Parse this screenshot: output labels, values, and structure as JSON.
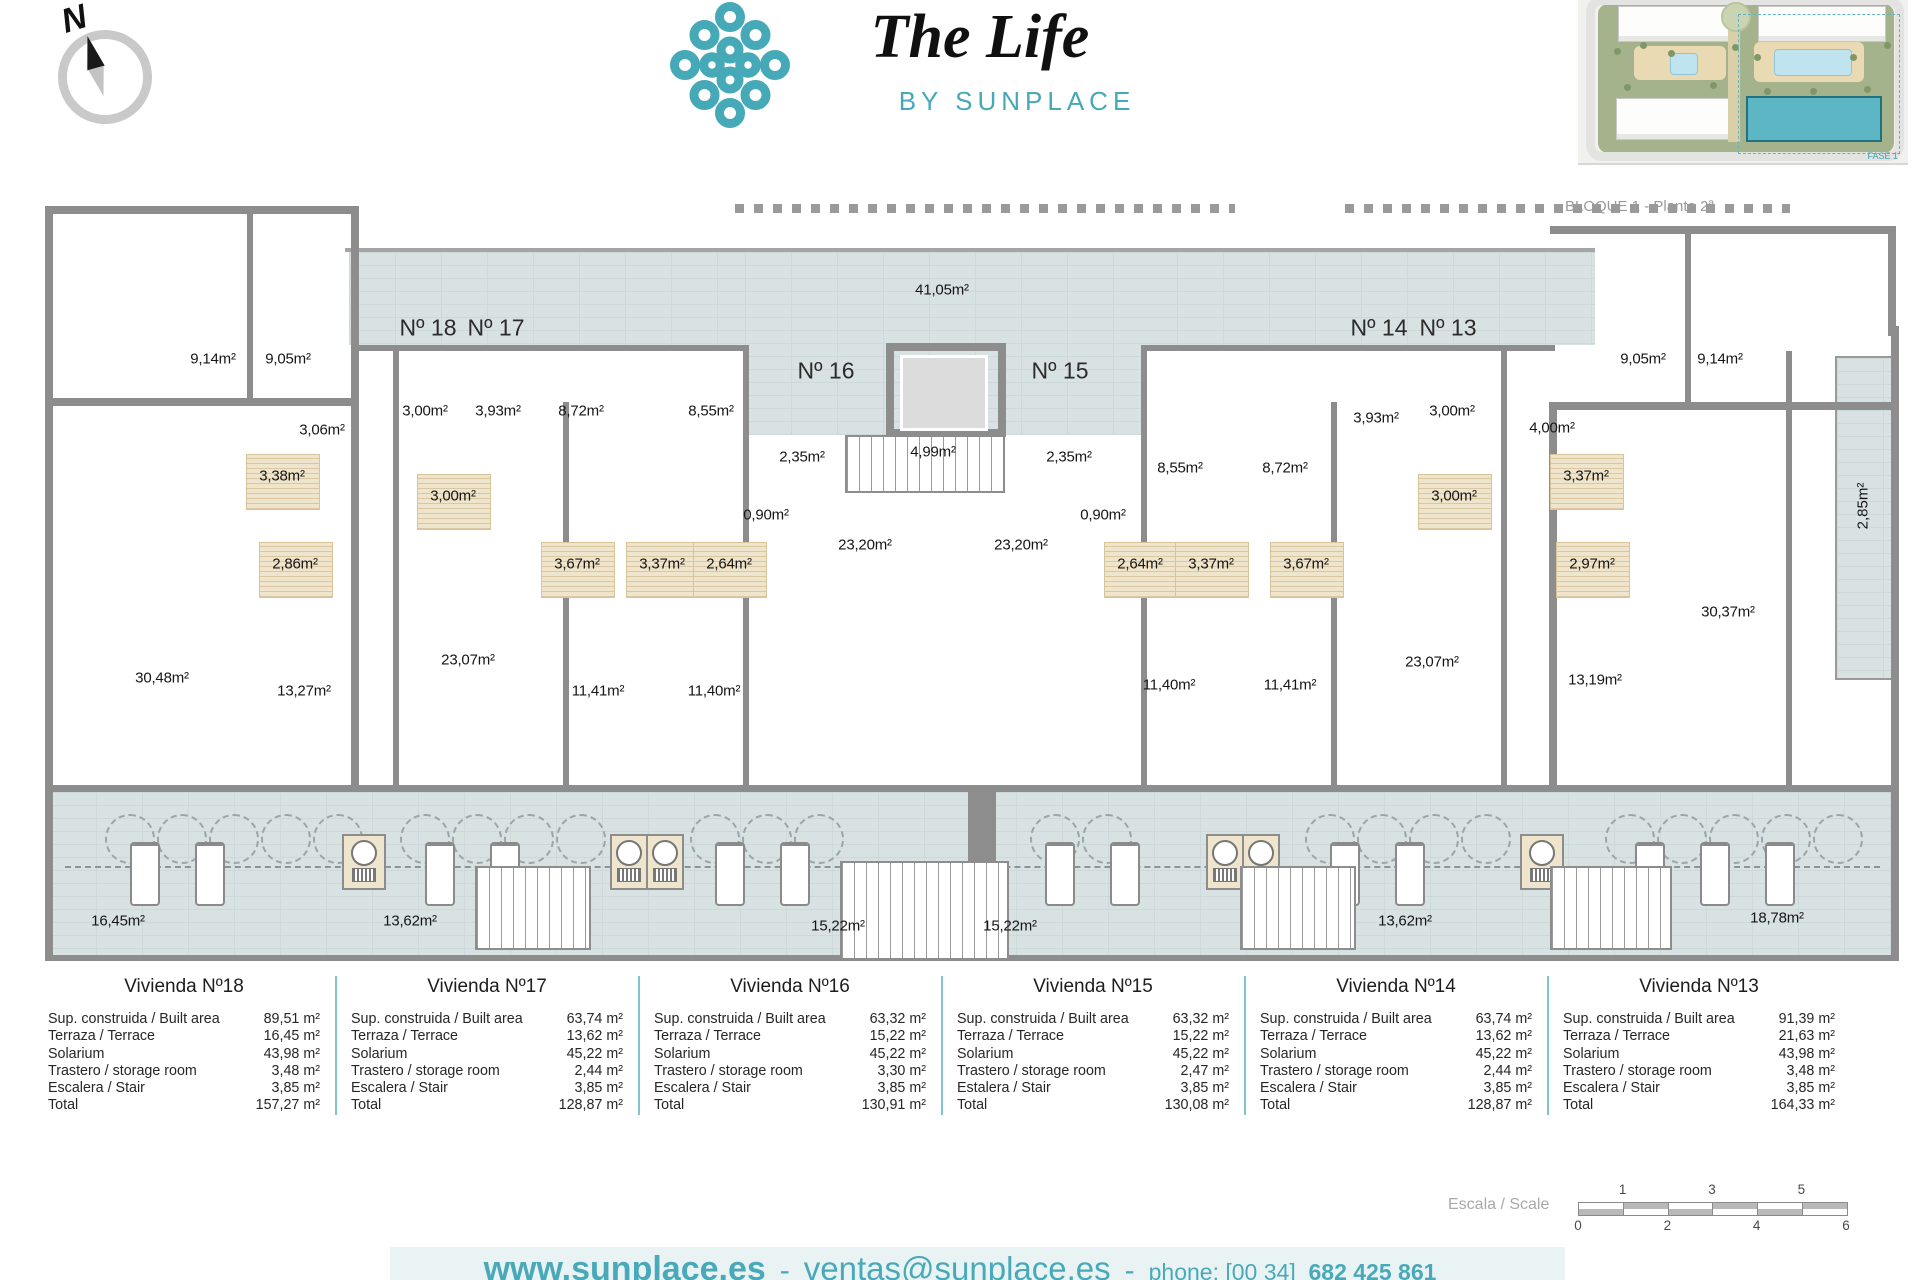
{
  "compass": {
    "letter": "N"
  },
  "logo": {
    "title": "The Life",
    "subtitle": "BY SUNPLACE",
    "accent": "#45a9b8"
  },
  "site_plan": {
    "caption": "BLOQUE 1 - Planta 2ª",
    "fase_label": "FASE 1"
  },
  "plan": {
    "unit_labels": [
      {
        "t": "Nº 18",
        "x": 383,
        "y": 122
      },
      {
        "t": "Nº 17",
        "x": 451,
        "y": 122
      },
      {
        "t": "Nº 16",
        "x": 781,
        "y": 165
      },
      {
        "t": "Nº 15",
        "x": 1015,
        "y": 165
      },
      {
        "t": "Nº 14",
        "x": 1334,
        "y": 122
      },
      {
        "t": "Nº 13",
        "x": 1403,
        "y": 122
      }
    ],
    "area_labels": [
      {
        "t": "41,05m²",
        "x": 897,
        "y": 84
      },
      {
        "t": "9,14m²",
        "x": 168,
        "y": 153
      },
      {
        "t": "9,05m²",
        "x": 243,
        "y": 153
      },
      {
        "t": "3,06m²",
        "x": 277,
        "y": 224
      },
      {
        "t": "3,00m²",
        "x": 380,
        "y": 205
      },
      {
        "t": "3,93m²",
        "x": 453,
        "y": 205
      },
      {
        "t": "8,72m²",
        "x": 536,
        "y": 205
      },
      {
        "t": "8,55m²",
        "x": 666,
        "y": 205
      },
      {
        "t": "2,35m²",
        "x": 757,
        "y": 251
      },
      {
        "t": "4,99m²",
        "x": 888,
        "y": 246
      },
      {
        "t": "2,35m²",
        "x": 1024,
        "y": 251
      },
      {
        "t": "3,38m²",
        "x": 237,
        "y": 270,
        "bath": true
      },
      {
        "t": "3,00m²",
        "x": 408,
        "y": 290,
        "bath": true
      },
      {
        "t": "0,90m²",
        "x": 721,
        "y": 309
      },
      {
        "t": "0,90m²",
        "x": 1058,
        "y": 309
      },
      {
        "t": "2,86m²",
        "x": 250,
        "y": 358,
        "bath": true
      },
      {
        "t": "3,67m²",
        "x": 532,
        "y": 358,
        "bath": true
      },
      {
        "t": "3,37m²",
        "x": 617,
        "y": 358,
        "bath": true
      },
      {
        "t": "2,64m²",
        "x": 684,
        "y": 358,
        "bath": true
      },
      {
        "t": "23,20m²",
        "x": 820,
        "y": 339
      },
      {
        "t": "23,20m²",
        "x": 976,
        "y": 339
      },
      {
        "t": "2,64m²",
        "x": 1095,
        "y": 358,
        "bath": true
      },
      {
        "t": "3,37m²",
        "x": 1166,
        "y": 358,
        "bath": true
      },
      {
        "t": "3,67m²",
        "x": 1261,
        "y": 358,
        "bath": true
      },
      {
        "t": "8,55m²",
        "x": 1135,
        "y": 262
      },
      {
        "t": "8,72m²",
        "x": 1240,
        "y": 262
      },
      {
        "t": "3,93m²",
        "x": 1331,
        "y": 212
      },
      {
        "t": "3,00m²",
        "x": 1407,
        "y": 205
      },
      {
        "t": "9,05m²",
        "x": 1598,
        "y": 153
      },
      {
        "t": "9,14m²",
        "x": 1675,
        "y": 153
      },
      {
        "t": "4,00m²",
        "x": 1507,
        "y": 222
      },
      {
        "t": "3,00m²",
        "x": 1409,
        "y": 290,
        "bath": true
      },
      {
        "t": "3,37m²",
        "x": 1541,
        "y": 270,
        "bath": true
      },
      {
        "t": "2,97m²",
        "x": 1547,
        "y": 358,
        "bath": true
      },
      {
        "t": "30,48m²",
        "x": 117,
        "y": 472
      },
      {
        "t": "13,27m²",
        "x": 259,
        "y": 485
      },
      {
        "t": "23,07m²",
        "x": 423,
        "y": 454
      },
      {
        "t": "11,41m²",
        "x": 553,
        "y": 485
      },
      {
        "t": "11,40m²",
        "x": 669,
        "y": 485
      },
      {
        "t": "11,40m²",
        "x": 1124,
        "y": 479
      },
      {
        "t": "11,41m²",
        "x": 1245,
        "y": 479
      },
      {
        "t": "23,07m²",
        "x": 1387,
        "y": 456
      },
      {
        "t": "13,19m²",
        "x": 1550,
        "y": 474
      },
      {
        "t": "30,37m²",
        "x": 1683,
        "y": 406
      },
      {
        "t": "16,45m²",
        "x": 73,
        "y": 715
      },
      {
        "t": "13,62m²",
        "x": 365,
        "y": 715
      },
      {
        "t": "15,22m²",
        "x": 793,
        "y": 720
      },
      {
        "t": "15,22m²",
        "x": 965,
        "y": 720
      },
      {
        "t": "13,62m²",
        "x": 1360,
        "y": 715
      },
      {
        "t": "18,78m²",
        "x": 1732,
        "y": 712
      }
    ],
    "vertical_labels": [
      {
        "t": "2,85m²",
        "x": 1818,
        "y": 300
      }
    ]
  },
  "tables": [
    {
      "title": "Vivienda Nº18",
      "rows": [
        {
          "label": "Sup. construida / Built area",
          "value": "89,51 m²"
        },
        {
          "label": "Terraza / Terrace",
          "value": "16,45 m²"
        },
        {
          "label": "Solarium",
          "value": "43,98 m²"
        },
        {
          "label": "Trastero / storage room",
          "value": "3,48 m²"
        },
        {
          "label": "Escalera / Stair",
          "value": "3,85 m²"
        },
        {
          "label": "Total",
          "value": "157,27 m²"
        }
      ]
    },
    {
      "title": "Vivienda Nº17",
      "rows": [
        {
          "label": "Sup. construida / Built area",
          "value": "63,74 m²"
        },
        {
          "label": "Terraza / Terrace",
          "value": "13,62 m²"
        },
        {
          "label": "Solarium",
          "value": "45,22 m²"
        },
        {
          "label": "Trastero / storage room",
          "value": "2,44 m²"
        },
        {
          "label": "Escalera / Stair",
          "value": "3,85 m²"
        },
        {
          "label": "Total",
          "value": "128,87 m²"
        }
      ]
    },
    {
      "title": "Vivienda Nº16",
      "rows": [
        {
          "label": "Sup. construida / Built area",
          "value": "63,32 m²"
        },
        {
          "label": "Terraza / Terrace",
          "value": "15,22 m²"
        },
        {
          "label": "Solarium",
          "value": "45,22 m²"
        },
        {
          "label": "Trastero / storage room",
          "value": "3,30 m²"
        },
        {
          "label": "Escalera / Stair",
          "value": "3,85 m²"
        },
        {
          "label": "Total",
          "value": "130,91 m²"
        }
      ]
    },
    {
      "title": "Vivienda Nº15",
      "rows": [
        {
          "label": "Sup. construida / Built area",
          "value": "63,32 m²"
        },
        {
          "label": "Terraza / Terrace",
          "value": "15,22 m²"
        },
        {
          "label": "Solarium",
          "value": "45,22 m²"
        },
        {
          "label": "Trastero / storage room",
          "value": "2,47 m²"
        },
        {
          "label": "Estalera / Stair",
          "value": "3,85 m²"
        },
        {
          "label": "Total",
          "value": "130,08 m²"
        }
      ]
    },
    {
      "title": "Vivienda Nº14",
      "rows": [
        {
          "label": "Sup. construida / Built area",
          "value": "63,74 m²"
        },
        {
          "label": "Terraza / Terrace",
          "value": "13,62 m²"
        },
        {
          "label": "Solarium",
          "value": "45,22 m²"
        },
        {
          "label": "Trastero / storage room",
          "value": "2,44 m²"
        },
        {
          "label": "Escalera / Stair",
          "value": "3,85 m²"
        },
        {
          "label": "Total",
          "value": "128,87 m²"
        }
      ]
    },
    {
      "title": "Vivienda Nº13",
      "rows": [
        {
          "label": "Sup. construida / Built area",
          "value": "91,39 m²"
        },
        {
          "label": "Terraza / Terrace",
          "value": "21,63 m²"
        },
        {
          "label": "Solarium",
          "value": "43,98 m²"
        },
        {
          "label": "Trastero / storage room",
          "value": "3,48 m²"
        },
        {
          "label": "Escalera / Stair",
          "value": "3,85 m²"
        },
        {
          "label": "Total",
          "value": "164,33 m²"
        }
      ]
    }
  ],
  "scale_bar": {
    "label": "Escala / Scale",
    "top_ticks": [
      "1",
      "3",
      "5"
    ],
    "bottom_ticks": [
      "0",
      "2",
      "4",
      "6"
    ]
  },
  "footer": {
    "website": "www.sunplace.es",
    "sep1": "-",
    "email": "ventas@sunplace.es",
    "sep2": "-",
    "phone_prefix": "phone: [00 34]",
    "phone_number": "682 425 861"
  }
}
